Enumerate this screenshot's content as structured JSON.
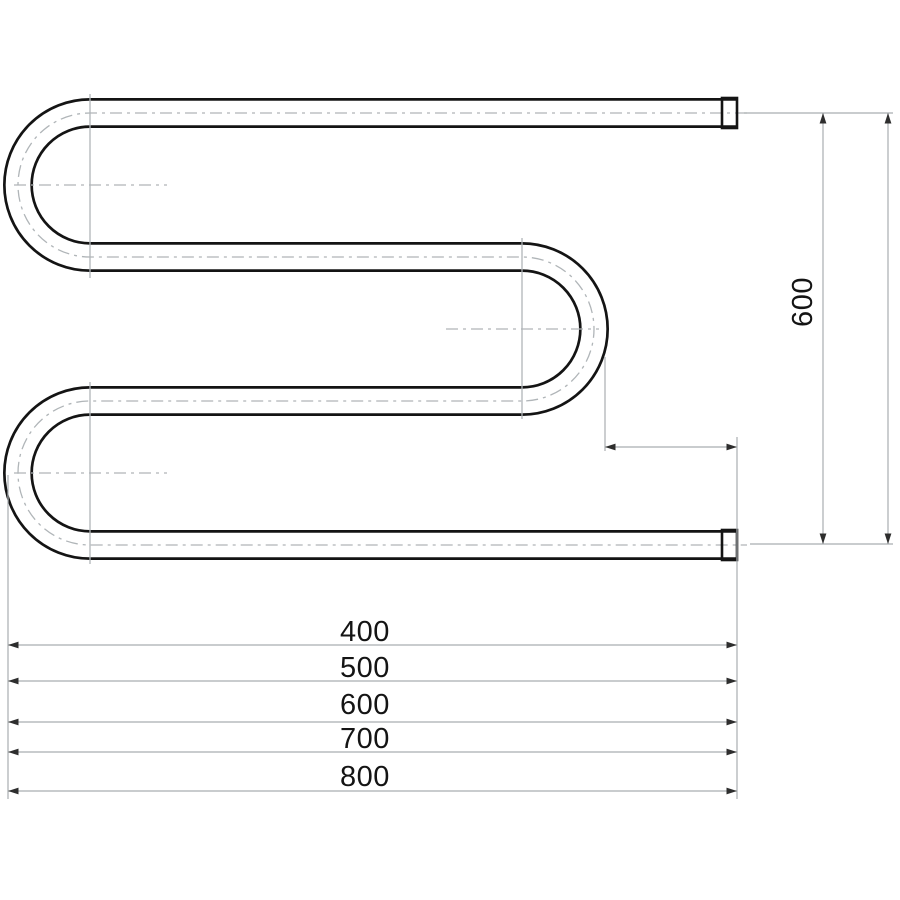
{
  "drawing": {
    "type": "technical-drawing",
    "subject": "s-shaped-towel-rail-pipe",
    "height_dimension": {
      "label": "600"
    },
    "width_dimensions": [
      {
        "label": "400"
      },
      {
        "label": "500"
      },
      {
        "label": "600"
      },
      {
        "label": "700"
      },
      {
        "label": "800"
      }
    ],
    "colors": {
      "outline": "#141414",
      "centerline": "#b0b5b8",
      "dimension_line": "#a9aeb1",
      "arrow": "#2e2e2e",
      "text": "#141414",
      "background": "#ffffff"
    }
  }
}
